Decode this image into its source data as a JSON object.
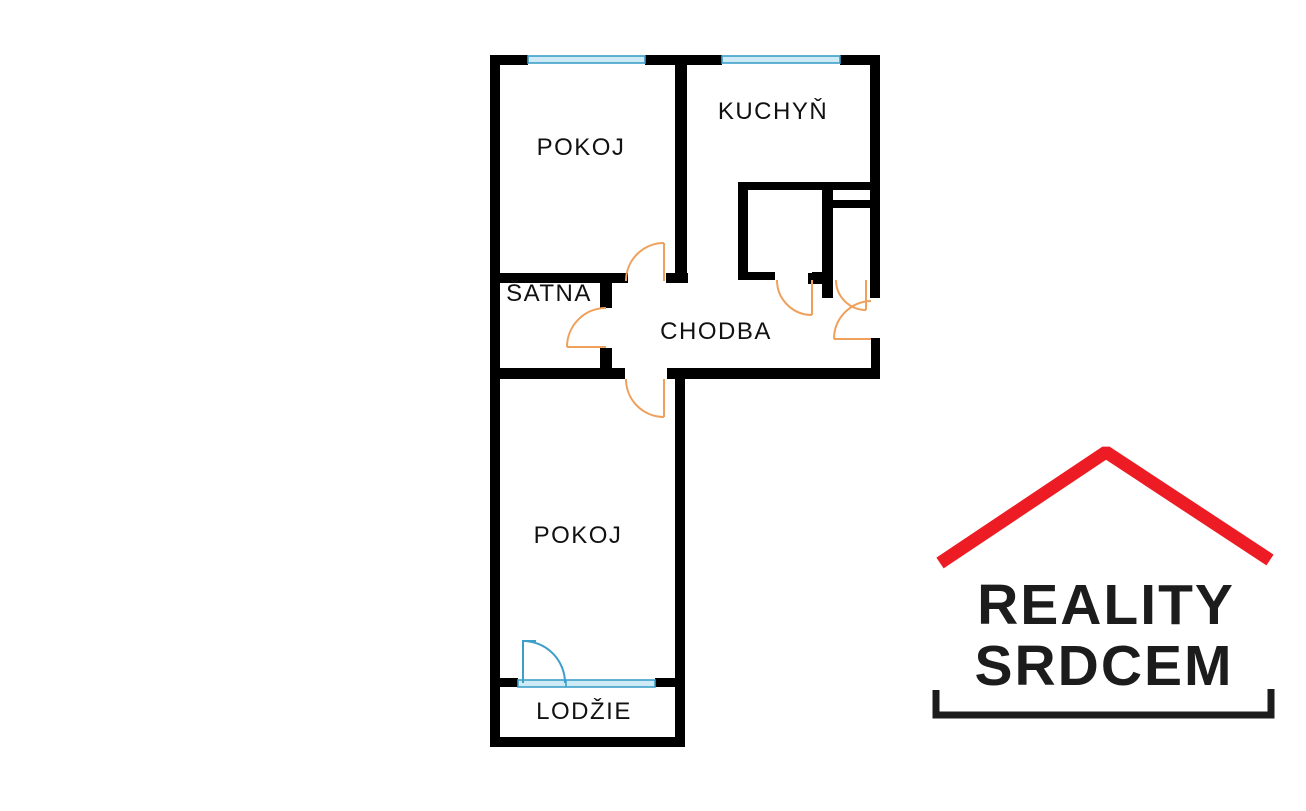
{
  "floorplan": {
    "rooms": [
      {
        "name": "pokoj-top",
        "label": "POKOJ"
      },
      {
        "name": "kuchyn",
        "label": "KUCHYŇ"
      },
      {
        "name": "satna",
        "label": "ŠATNA"
      },
      {
        "name": "chodba",
        "label": "CHODBA"
      },
      {
        "name": "pokoj-bottom",
        "label": "POKOJ"
      },
      {
        "name": "lodzie",
        "label": "LODŽIE"
      }
    ],
    "colors": {
      "wall": "#000000",
      "door": "#efa05a",
      "window_stroke": "#3d9fc9",
      "window_fill": "#cdeaf5",
      "balcony_door": "#3d9fc9"
    }
  },
  "logo": {
    "line1": "REALITY",
    "line2": "SRDCEM",
    "roof_color": "#ed1c24",
    "text_color": "#1c1c1c"
  }
}
